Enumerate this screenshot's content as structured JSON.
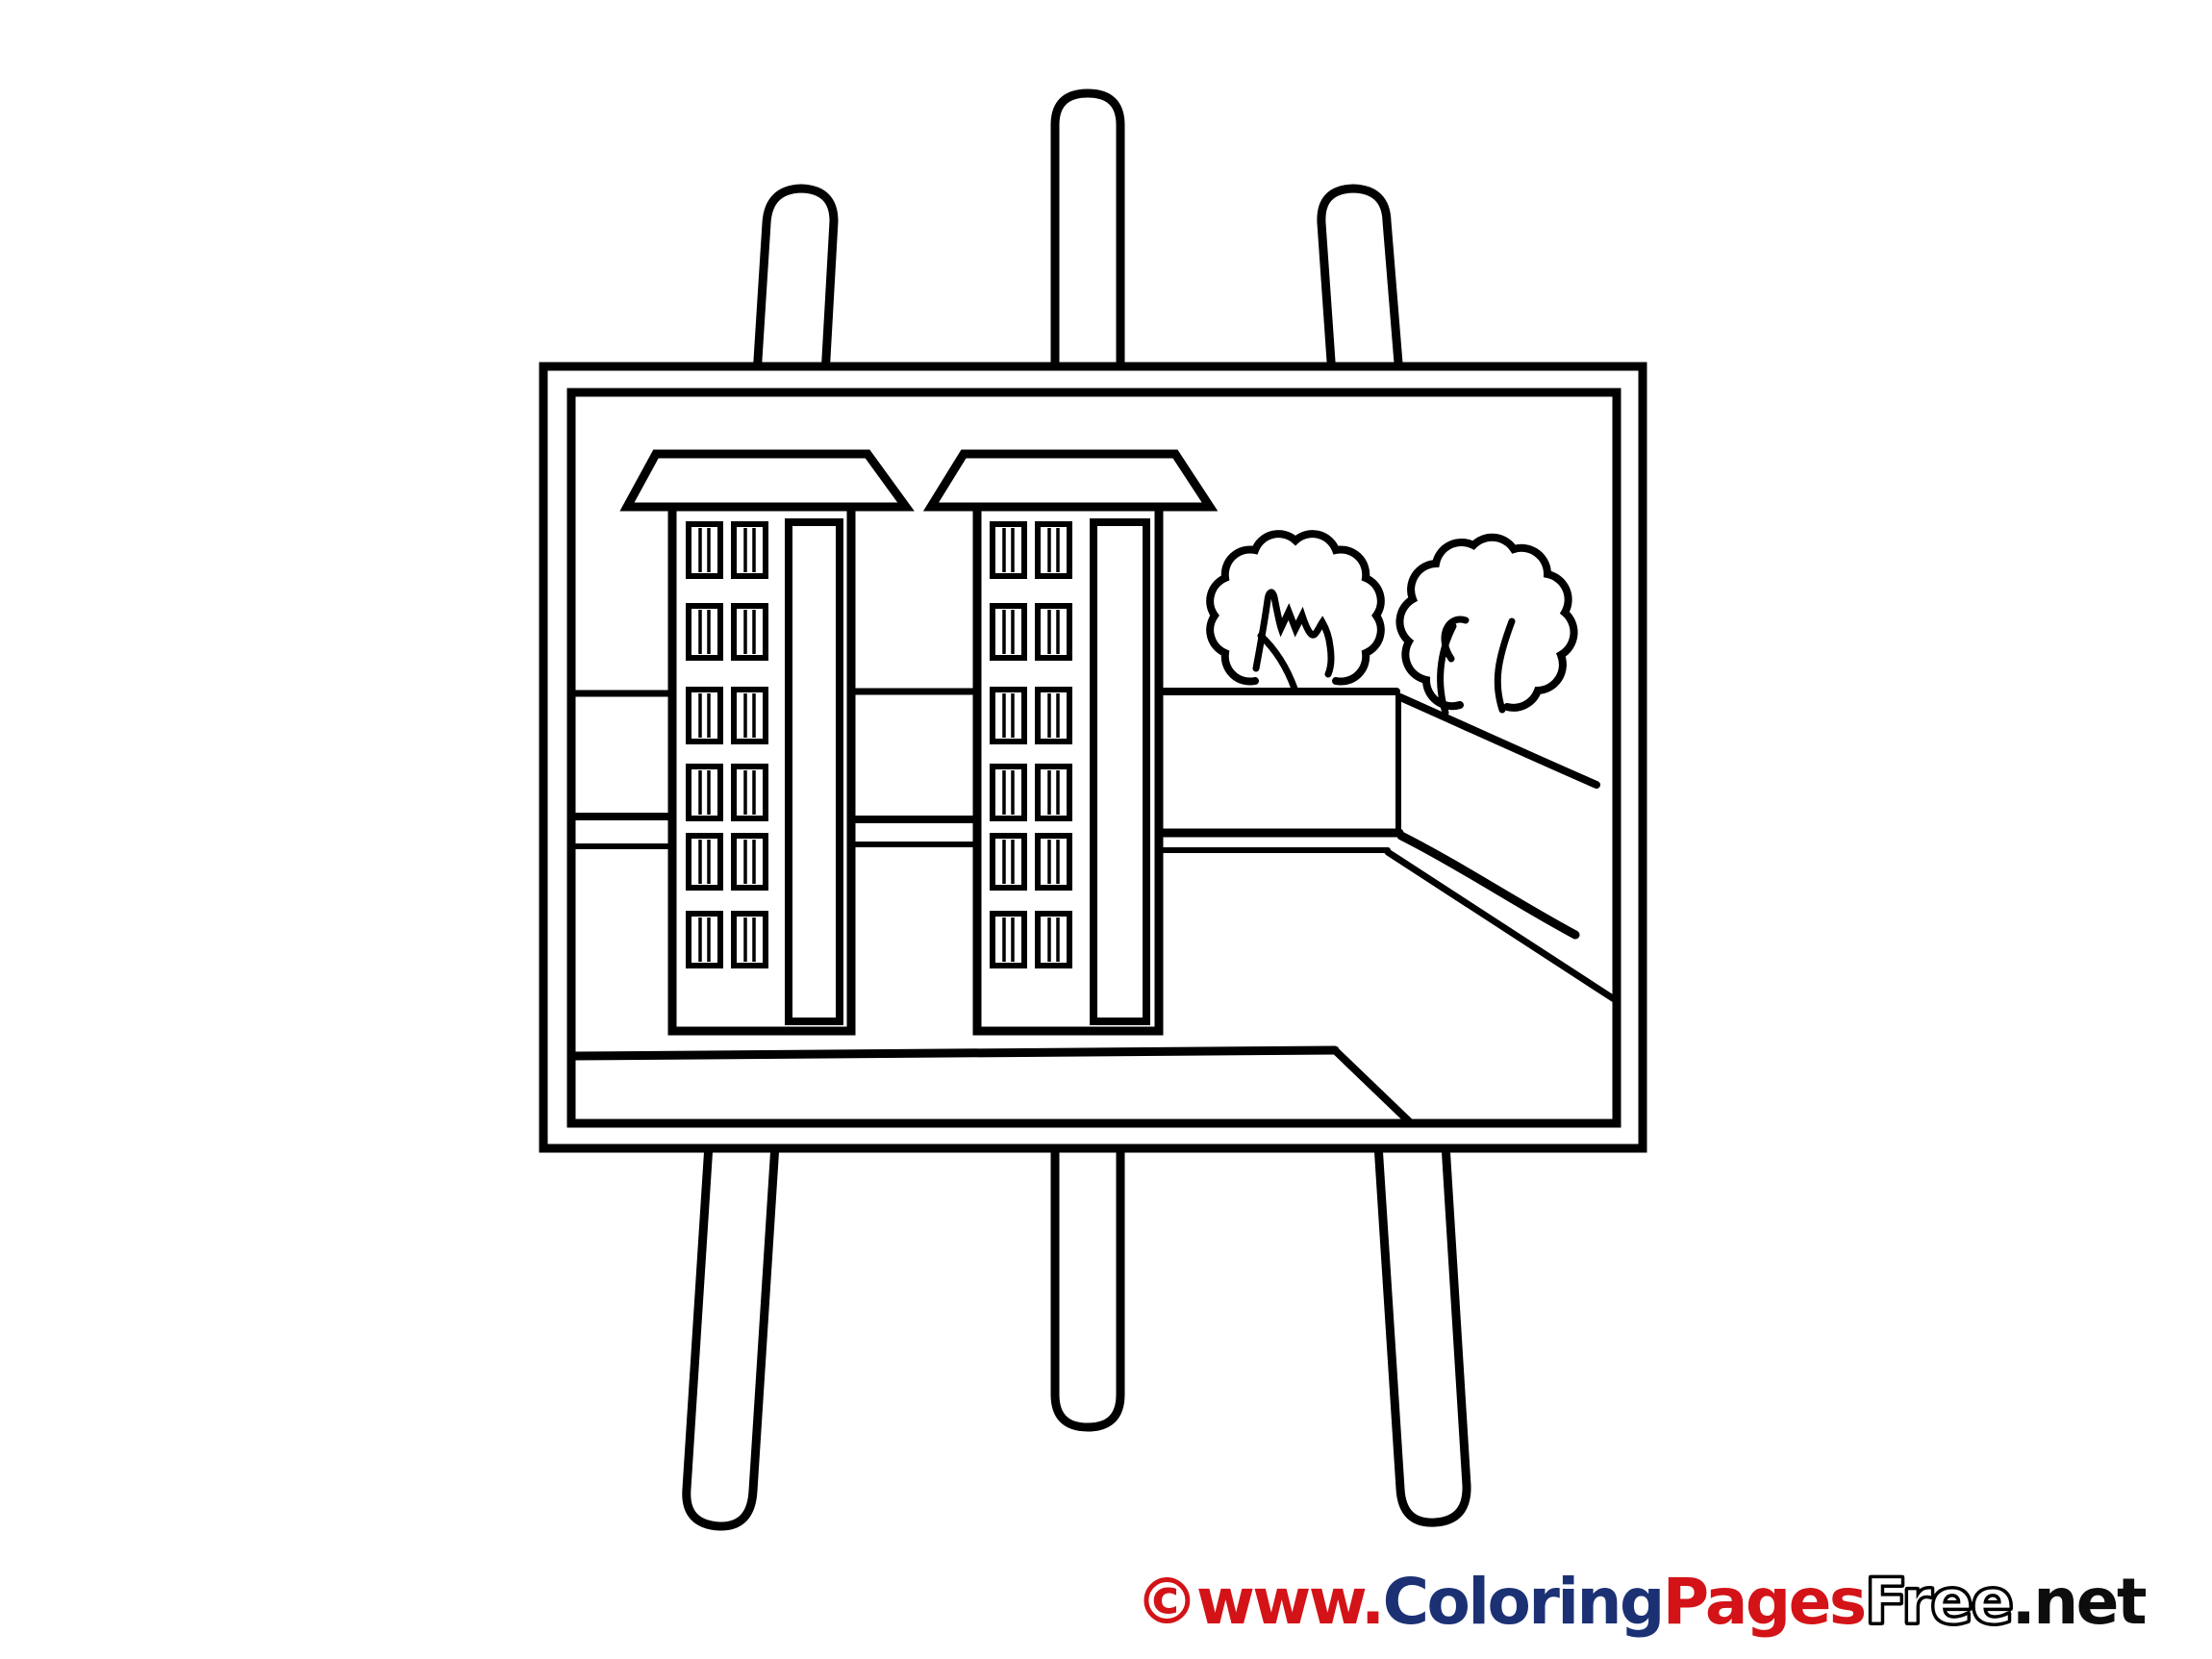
{
  "page": {
    "background_color": "#ffffff",
    "ink_color": "#000000"
  },
  "artwork": {
    "kind": "coloring page line drawing",
    "subject": "easel holding a painting of two apartment buildings, two trees and a street"
  },
  "scene": {
    "buildings": [
      {
        "name": "left apartment building",
        "window_rows": 6,
        "window_cols": 2
      },
      {
        "name": "right apartment building",
        "window_rows": 6,
        "window_cols": 2
      }
    ],
    "tree_count": 2
  },
  "watermark": {
    "segments": [
      {
        "text": "©www.",
        "color": "#d31317",
        "style": "solid"
      },
      {
        "text": "Coloring",
        "color": "#1b3174",
        "style": "solid"
      },
      {
        "text": "Pages",
        "color": "#d31317",
        "style": "solid"
      },
      {
        "text": "Free",
        "color": "#ffffff",
        "style": "outline",
        "outline_color": "#000000"
      },
      {
        "text": ".net",
        "color": "#0d0d0d",
        "style": "solid"
      }
    ]
  }
}
